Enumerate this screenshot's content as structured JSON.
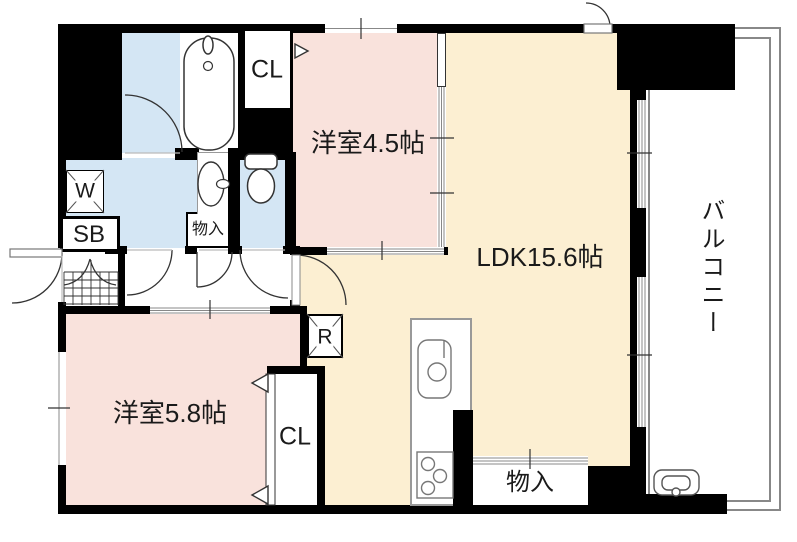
{
  "plan": {
    "title": "apartment-floorplan",
    "rooms": {
      "western_45": {
        "label": "洋室4.5帖"
      },
      "ldk": {
        "label": "LDK15.6帖"
      },
      "western_58": {
        "label": "洋室5.8帖"
      },
      "balcony": {
        "label": "バルコニー"
      }
    },
    "fixtures": {
      "closet_upper": {
        "label": "CL"
      },
      "closet_lower": {
        "label": "CL"
      },
      "shoebox": {
        "label": "SB"
      },
      "washer": {
        "label": "W"
      },
      "refrigerator": {
        "label": "R"
      },
      "storage_hall": {
        "label": "物入"
      },
      "storage_kitchen": {
        "label": "物入"
      }
    },
    "colors": {
      "wall": "#000000",
      "room_pink": "#f9e2dc",
      "room_cream": "#fcefd2",
      "wet_area_blue": "#d4e6f4",
      "balcony_line_gray": "#888888"
    }
  }
}
